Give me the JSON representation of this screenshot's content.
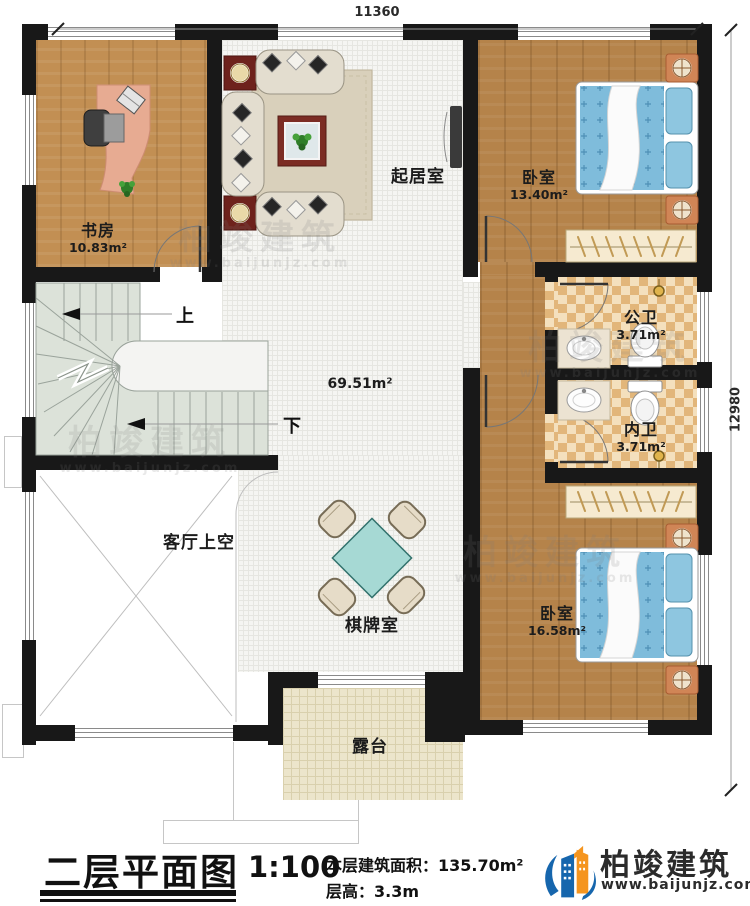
{
  "dimensions": {
    "top": "11360",
    "right": "12980"
  },
  "rooms": {
    "study": {
      "name": "书房",
      "area": "10.83m²"
    },
    "living": {
      "name": "起居室"
    },
    "bedroom1": {
      "name": "卧室",
      "area": "13.40m²"
    },
    "public_bath": {
      "name": "公卫",
      "area": "3.71m²"
    },
    "inner_bath": {
      "name": "内卫",
      "area": "3.71m²"
    },
    "bedroom2": {
      "name": "卧室",
      "area": "16.58m²"
    },
    "game_room": {
      "name": "棋牌室"
    },
    "living_void": {
      "name": "客厅上空"
    },
    "terrace": {
      "name": "露台"
    },
    "hall": {
      "area": "69.51m²"
    }
  },
  "stairs": {
    "up": "上",
    "down": "下"
  },
  "title_block": {
    "title": "二层平面图",
    "scale": "1:100",
    "floor_area_label": "本层建筑面积：",
    "floor_area_value": "135.70m²",
    "floor_height_label": "层高：",
    "floor_height_value": "3.3m"
  },
  "brand": {
    "name": "柏竣建筑",
    "url": "www.baijunjz.com"
  },
  "watermark": {
    "name": "柏竣建筑",
    "url": "www.baijunjz.com"
  },
  "colors": {
    "wall": "#181818",
    "wood": "#b5834a",
    "tile": "#f5f5f2",
    "bath_check": "#e2b67a",
    "terrace": "#ece5cb",
    "stair": "#dce2d9",
    "mattress": "#7fbcdb",
    "brand_blue": "#1666ad",
    "brand_orange": "#f5951f"
  }
}
